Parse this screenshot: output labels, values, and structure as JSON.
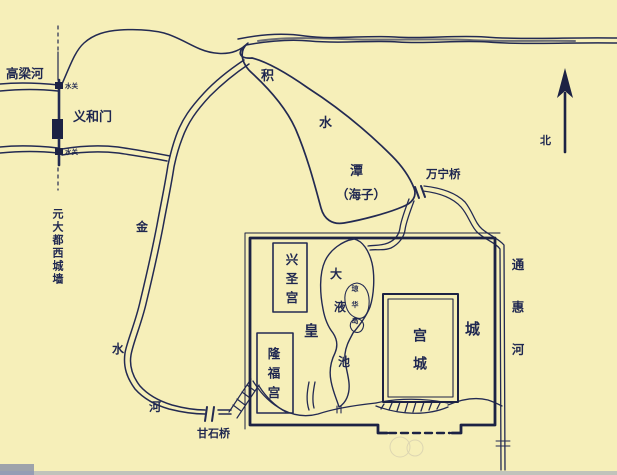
{
  "colors": {
    "background": "#f6efb9",
    "ink": "#232a52",
    "wall_ink": "#1c2244",
    "text": "#1f2750",
    "edge_tint": "#6a7aa8"
  },
  "map": {
    "rivers": {
      "gaoliang": "高梁河",
      "jishuitan": {
        "ji": "积",
        "shui": "水",
        "tan": "潭",
        "haizi": "（海子）"
      },
      "jinshui": {
        "jin": "金",
        "shui": "水",
        "he": "河"
      },
      "tonghui": "通惠河"
    },
    "gates": {
      "yihemen": "义和门",
      "watergate": "水关"
    },
    "bridges": {
      "wanning": "万宁桥",
      "ganshi": "甘石桥"
    },
    "walls": {
      "west": "元大都西城墙",
      "imperial": {
        "huang": "皇",
        "cheng": "城"
      }
    },
    "palaces": {
      "xingsheng": "兴圣宫",
      "longfu": "隆福宫",
      "palace_city": "宫城"
    },
    "lake": {
      "da": "大",
      "ye": "液",
      "chi": "池",
      "island": "琼华岛"
    },
    "compass": {
      "north": "北"
    }
  }
}
